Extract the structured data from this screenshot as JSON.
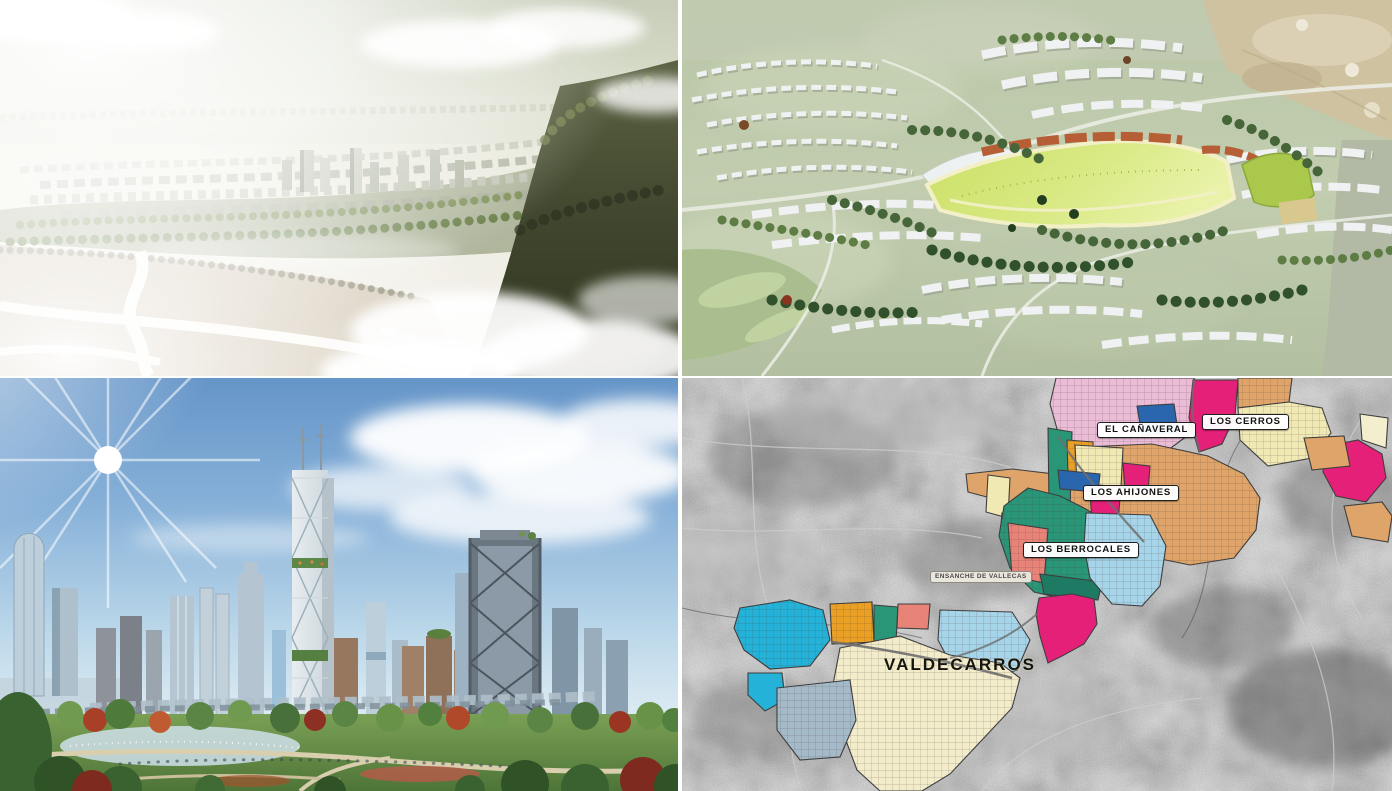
{
  "map_panel": {
    "labels": {
      "el_canaveral": "EL CAÑAVERAL",
      "los_cerros": "LOS CERROS",
      "los_ahijones": "LOS AHIJONES",
      "los_berrocales": "LOS BERROCALES",
      "ensanche_de_vallecas": "ENSANCHE DE VALLECAS",
      "valdecarros": "VALDECARROS"
    },
    "zone_colors": {
      "pink": "#eabcd6",
      "magenta": "#e42079",
      "blue": "#2a66ae",
      "cream": "#f0e9b4",
      "cream_pale": "#f3eecd",
      "tan": "#dfa469",
      "orange": "#eaa025",
      "teal": "#2a9678",
      "teal_dark": "#1e7a62",
      "salmon": "#e88378",
      "light_blue": "#a6d4e9",
      "cyan": "#25b2d8",
      "gray_blue": "#a5bac9",
      "cream_valdecarros": "#f2ecca"
    }
  }
}
